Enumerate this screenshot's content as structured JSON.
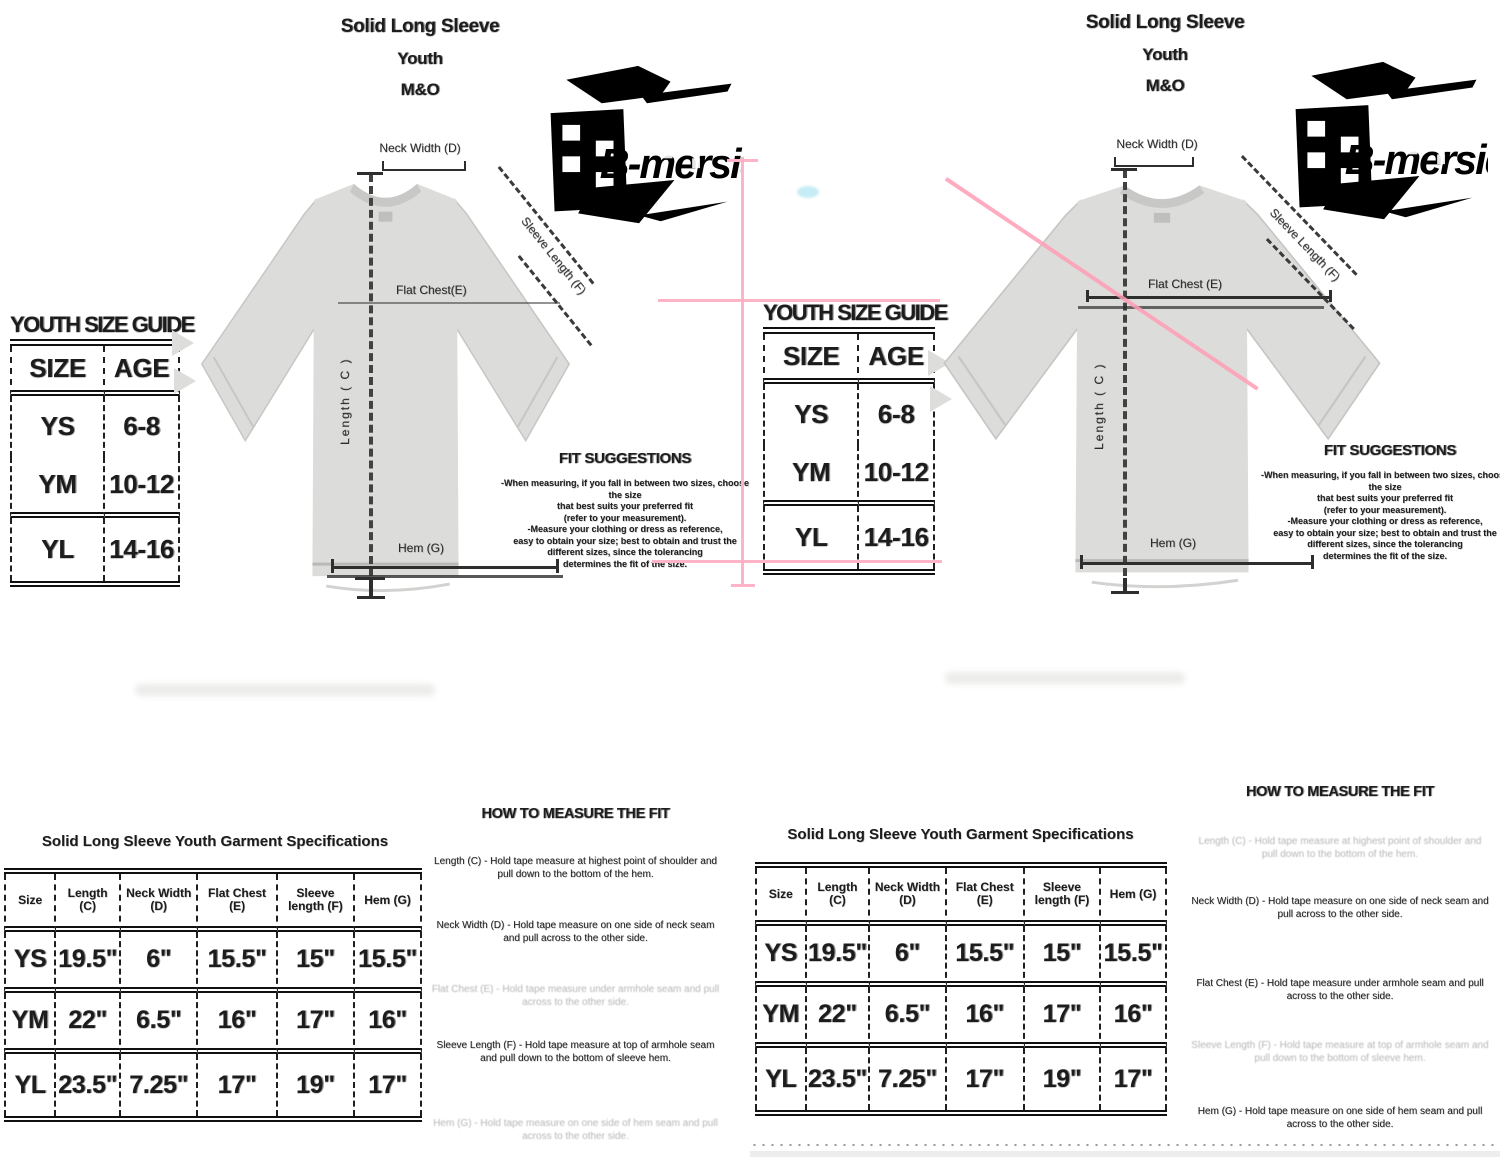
{
  "colors": {
    "pink_line": "#ffb3c6",
    "pink_diagonal": "#ff9db5",
    "shirt_gray": "#dcdcda",
    "logo_black": "#000000",
    "cyan_smudge": "#c6edf5"
  },
  "logo": {
    "text": "B-mersid"
  },
  "left": {
    "title": {
      "l1": "Solid Long Sleeve",
      "l2": "Youth",
      "l3": "M&O"
    },
    "labels": {
      "neck": "Neck Width (D)",
      "sleeve": "Sleeve Length (F)",
      "chest": "Flat Chest(E)",
      "length": "Length ( C )",
      "hem": "Hem (G)"
    },
    "guide": {
      "title": "YOUTH SIZE GUIDE",
      "h1": "SIZE",
      "h2": "AGE",
      "rows": [
        [
          "YS",
          "6-8"
        ],
        [
          "YM",
          "10-12"
        ],
        [
          "YL",
          "14-16"
        ]
      ]
    },
    "fit": {
      "heading": "FIT SUGGESTIONS",
      "lines": [
        "-When measuring, if you fall in between two sizes, choose the size",
        "that best suits your preferred fit",
        "(refer to your measurement).",
        "-Measure your clothing or dress as reference,",
        "easy to obtain your size; best to obtain and trust the",
        "different sizes, since the tolerancing",
        "determines the fit of the size."
      ]
    }
  },
  "center_guide": {
    "title": "YOUTH SIZE GUIDE",
    "h1": "SIZE",
    "h2": "AGE",
    "rows": [
      [
        "YS",
        "6-8"
      ],
      [
        "YM",
        "10-12"
      ],
      [
        "YL",
        "14-16"
      ]
    ]
  },
  "right": {
    "title": {
      "l1": "Solid Long Sleeve",
      "l2": "Youth",
      "l3": "M&O"
    },
    "labels": {
      "neck": "Neck Width (D)",
      "sleeve": "Sleeve Length (F)",
      "chest": "Flat Chest (E)",
      "length": "Length ( C )",
      "hem": "Hem (G)"
    },
    "fit": {
      "heading": "FIT SUGGESTIONS",
      "lines": [
        "-When measuring, if you fall in between two sizes, choose the size",
        "that best suits your preferred fit",
        "(refer to your measurement).",
        "-Measure your clothing or dress as reference,",
        "easy to obtain your size; best to obtain and trust the",
        "different sizes, since the tolerancing",
        "determines the fit of the size."
      ]
    }
  },
  "spec_left": {
    "title": "Solid Long Sleeve Youth Garment Specifications",
    "headers": [
      "Size",
      "Length (C)",
      "Neck Width (D)",
      "Flat Chest (E)",
      "Sleeve length (F)",
      "Hem (G)"
    ],
    "rows": [
      [
        "YS",
        "19.5\"",
        "6\"",
        "15.5\"",
        "15\"",
        "15.5\""
      ],
      [
        "YM",
        "22\"",
        "6.5\"",
        "16\"",
        "17\"",
        "16\""
      ],
      [
        "YL",
        "23.5\"",
        "7.25\"",
        "17\"",
        "19\"",
        "17\""
      ]
    ]
  },
  "spec_right": {
    "title": "Solid Long Sleeve Youth Garment Specifications",
    "headers": [
      "Size",
      "Length (C)",
      "Neck Width (D)",
      "Flat Chest (E)",
      "Sleeve length (F)",
      "Hem (G)"
    ],
    "rows": [
      [
        "YS",
        "19.5\"",
        "6\"",
        "15.5\"",
        "15\"",
        "15.5\""
      ],
      [
        "YM",
        "22\"",
        "6.5\"",
        "16\"",
        "17\"",
        "16\""
      ],
      [
        "YL",
        "23.5\"",
        "7.25\"",
        "17\"",
        "19\"",
        "17\""
      ]
    ]
  },
  "how_left": {
    "heading": "HOW TO MEASURE THE FIT",
    "paras": [
      "Length (C) - Hold tape measure at highest point of shoulder and pull down to the bottom of the hem.",
      "Neck Width (D) - Hold tape measure on one side of neck seam and pull across to the other side.",
      "Flat Chest (E) - Hold tape measure under armhole seam and pull across to the other side.",
      "Sleeve Length (F) - Hold tape measure at top of armhole seam and pull down to the bottom of sleeve hem.",
      "Hem (G) - Hold tape measure on one side of hem seam and pull across to the other side."
    ]
  },
  "how_right": {
    "heading": "HOW TO MEASURE THE FIT",
    "paras": [
      "Length (C) - Hold tape measure at highest point of shoulder and pull down to the bottom of the hem.",
      "Neck Width (D) - Hold tape measure on one side of neck seam and pull across to the other side.",
      "Flat Chest (E) - Hold tape measure under armhole seam and pull across to the other side.",
      "Sleeve Length (F) - Hold tape measure at top of armhole seam and pull down to the bottom of sleeve hem.",
      "Hem (G) - Hold tape measure on one side of hem seam and pull across to the other side."
    ]
  }
}
